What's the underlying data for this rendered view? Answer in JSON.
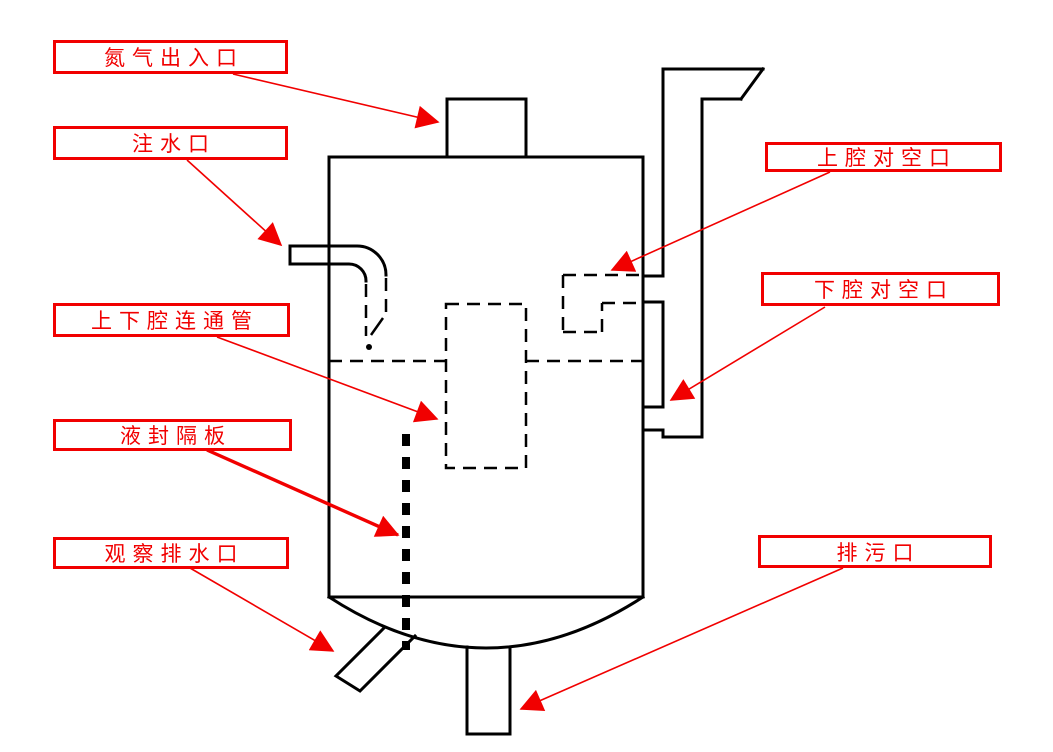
{
  "diagram": {
    "colors": {
      "annotation_red": "#f10000",
      "drawing_black": "#000000",
      "background": "#ffffff"
    },
    "labels": {
      "nitrogen_port": "氮气出入口",
      "water_inlet": "注水口",
      "upper_vent": "上腔对空口",
      "lower_vent": "下腔对空口",
      "connecting_pipe": "上下腔连通管",
      "seal_baffle": "液封隔板",
      "observation_drain": "观察排水口",
      "blowdown_port": "排污口"
    }
  }
}
